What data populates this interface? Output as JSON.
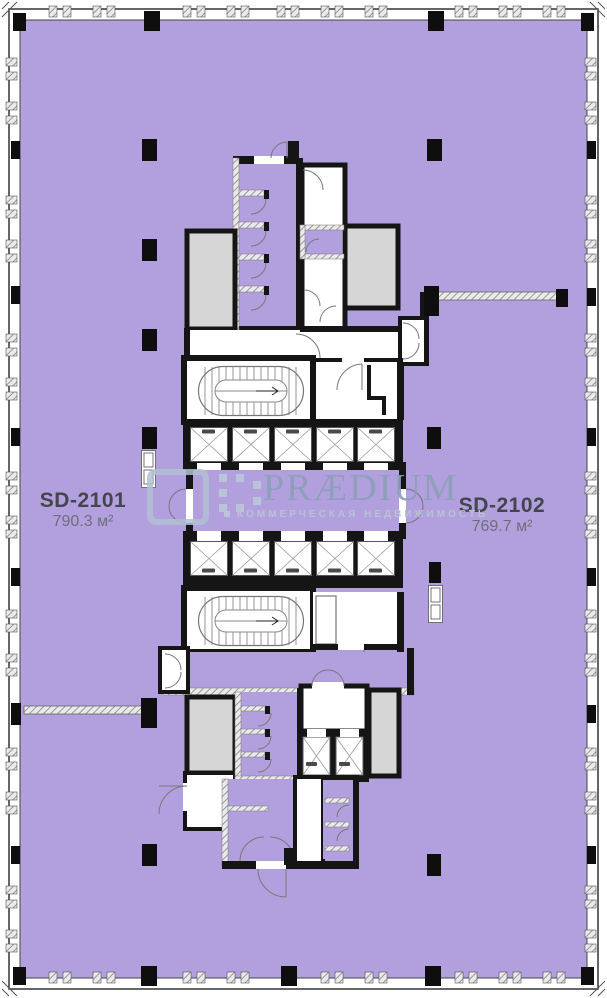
{
  "plan": {
    "units": [
      {
        "code": "SD-2101",
        "area": "790.3 м²"
      },
      {
        "code": "SD-2102",
        "area": "769.7 м²"
      }
    ],
    "brand": {
      "name": "PRÆDIUM",
      "tagline": "КОММЕРЧЕСКАЯ НЕДВИЖИМОСТЬ",
      "logo_mark": "dotted-square-bracket"
    },
    "colors": {
      "floor": "#b2a0de",
      "wall": "#151515",
      "shaft": "#d6d6d6",
      "brand_primary": "#8c9fb7",
      "brand_light": "#b7c3d2",
      "label": "#45454d",
      "label_area": "#6e6e7a"
    }
  }
}
